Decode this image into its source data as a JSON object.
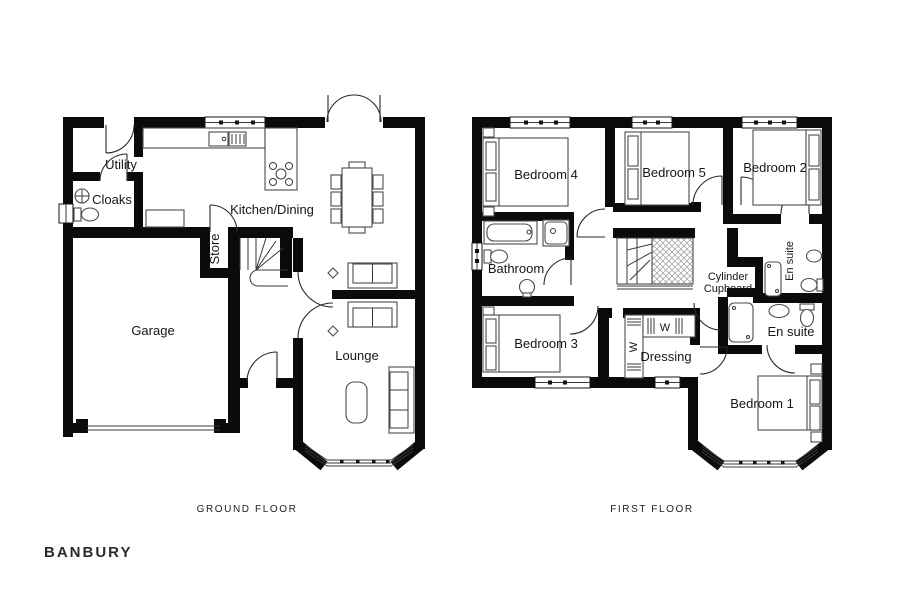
{
  "plan_title": "BANBURY",
  "ground_floor": {
    "label": "GROUND FLOOR",
    "rooms": {
      "utility": "Utility",
      "cloaks": "Cloaks",
      "kitchen_dining": "Kitchen/Dining",
      "store": "Store",
      "garage": "Garage",
      "lounge": "Lounge"
    }
  },
  "first_floor": {
    "label": "FIRST FLOOR",
    "rooms": {
      "bedroom4": "Bedroom 4",
      "bedroom5": "Bedroom 5",
      "bedroom2": "Bedroom 2",
      "bathroom": "Bathroom",
      "cylinder_cupboard_line1": "Cylinder",
      "cylinder_cupboard_line2": "Cupboard",
      "ensuite_bedroom2": "En suite",
      "ensuite_bedroom1": "En suite",
      "bedroom3": "Bedroom 3",
      "dressing": "Dressing",
      "bedroom1": "Bedroom 1",
      "wardrobe_marker": "W"
    }
  },
  "colors": {
    "wall": "#0b0b0b",
    "furniture_line": "#4c4c4c",
    "door_line": "#2a2a2a",
    "text": "#161616",
    "background": "#ffffff"
  }
}
